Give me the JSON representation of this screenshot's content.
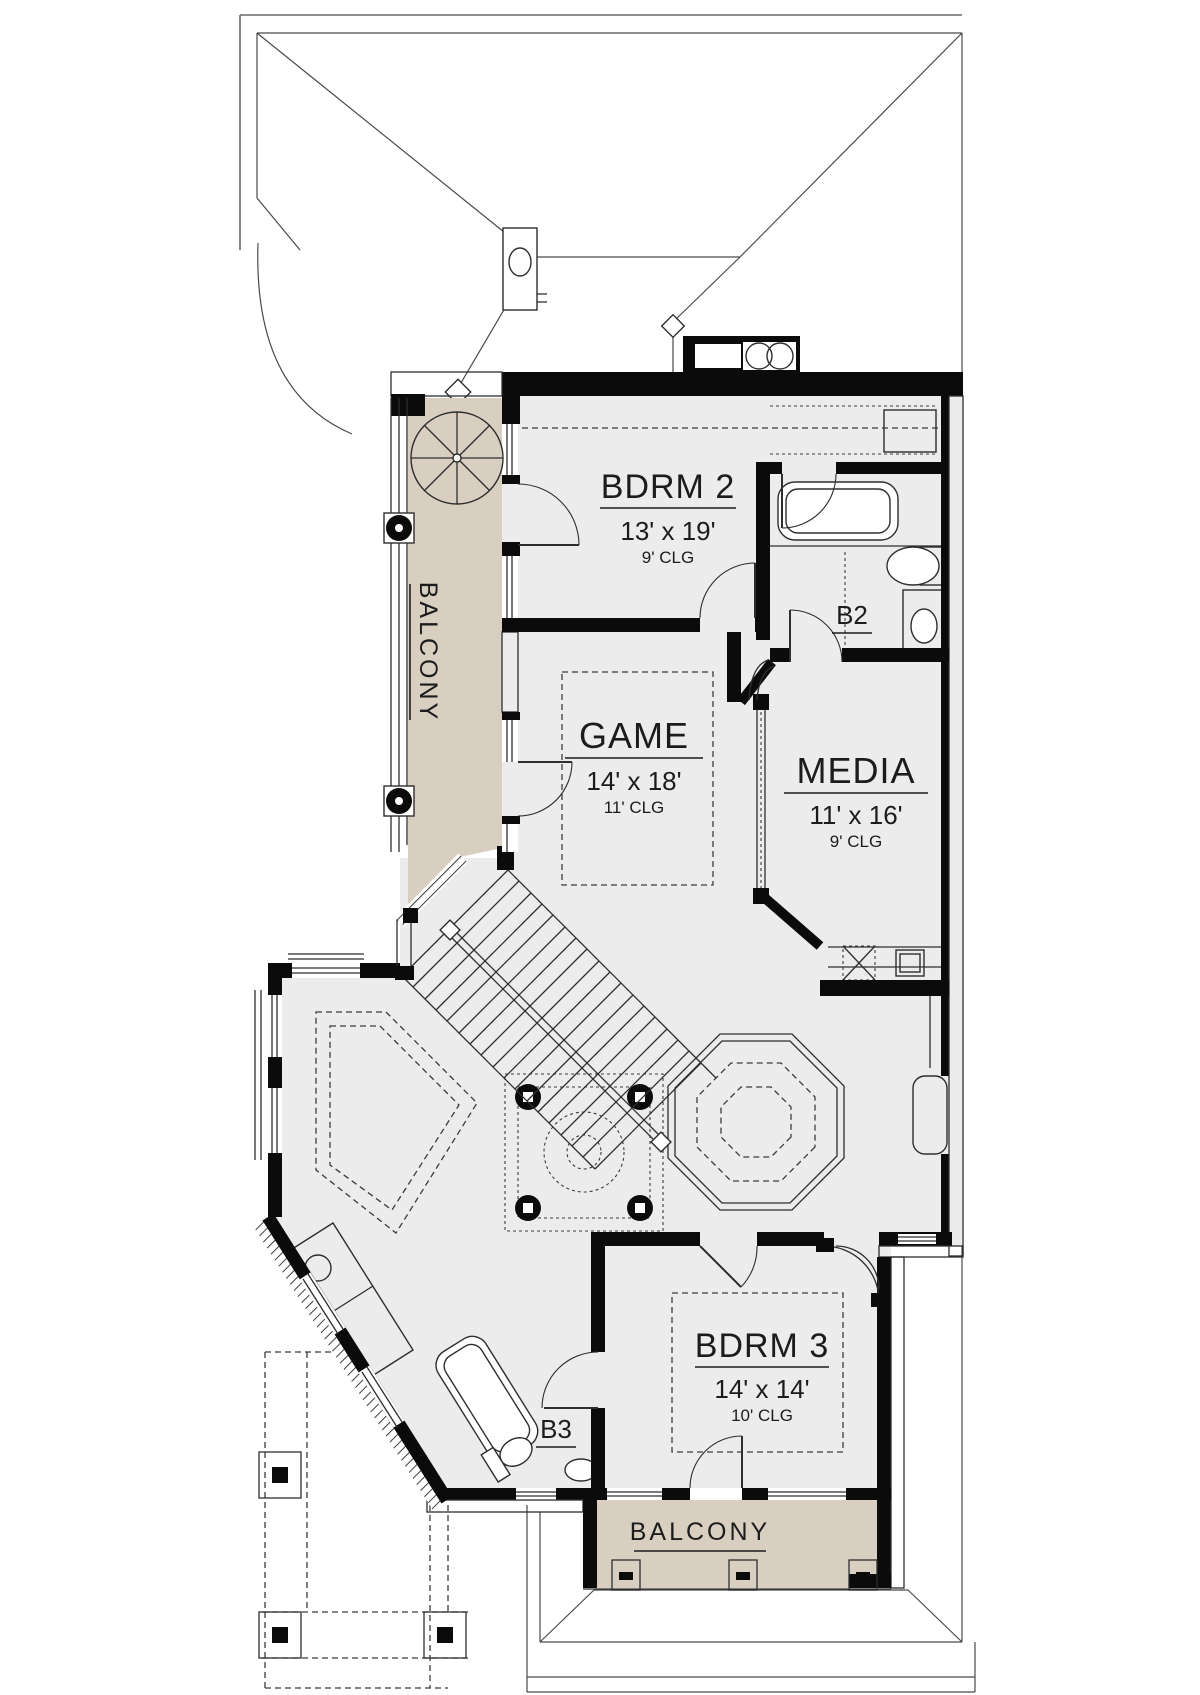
{
  "plan": {
    "type": "architectural-floor-plan",
    "rooms": {
      "bdrm2": {
        "name": "BDRM 2",
        "dims": "13' x 19'",
        "ceiling": "9' CLG"
      },
      "game": {
        "name": "GAME",
        "dims": "14' x 18'",
        "ceiling": "11' CLG"
      },
      "media": {
        "name": "MEDIA",
        "dims": "11' x 16'",
        "ceiling": "9' CLG"
      },
      "bdrm3": {
        "name": "BDRM 3",
        "dims": "14' x 14'",
        "ceiling": "10' CLG"
      },
      "bath2": {
        "name": "B2"
      },
      "bath3": {
        "name": "B3"
      },
      "balcony_left": {
        "name": "BALCONY"
      },
      "balcony_bottom": {
        "name": "BALCONY"
      }
    },
    "colors": {
      "floor_fill": "#ECECEC",
      "balcony_fill": "#D8CFC0",
      "wall": "#0B0B0B",
      "roof_line": "#4A4A4A"
    },
    "icons": [
      "spiral-staircase-icon",
      "chimney-icon",
      "fireplace-icon",
      "bathtub-icon",
      "toilet-icon",
      "sink-icon",
      "attic-access-icon",
      "column-icon",
      "staircase-icon",
      "dome-ceiling-icon"
    ]
  }
}
